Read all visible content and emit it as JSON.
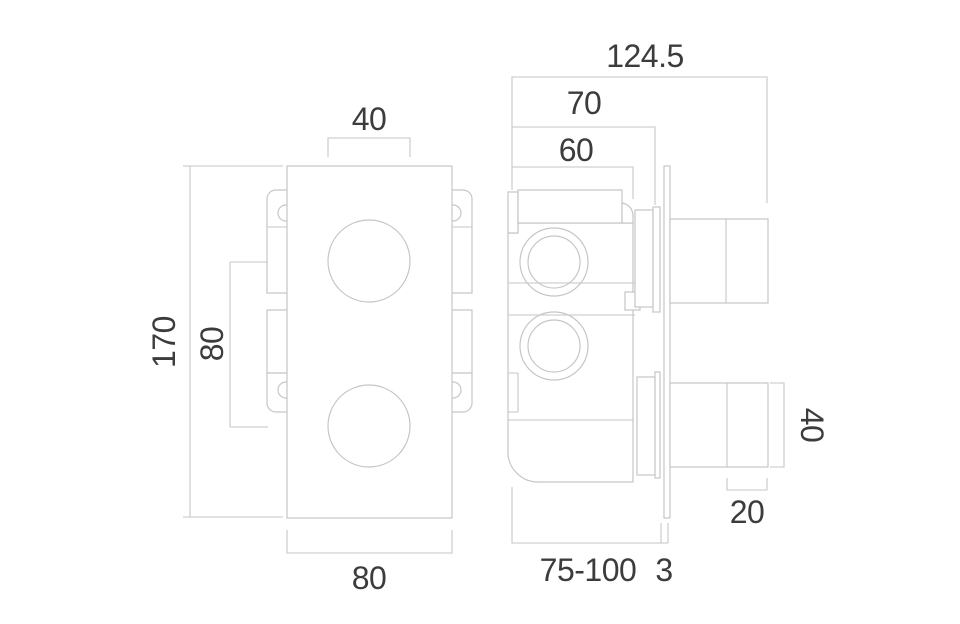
{
  "page": {
    "background": "#ffffff"
  },
  "drawing": {
    "title": "shower-valve-dimension-drawing",
    "line_color": "#c6c6c6",
    "text_color": "#3c3c3c",
    "views": {
      "front_view": {
        "name": "front view",
        "dimensions": {
          "hole_diameter": "40",
          "height": "170",
          "hole_spacing": "80",
          "width": "80"
        }
      },
      "side_view": {
        "name": "side view",
        "dimensions": {
          "overall_depth": "124.5",
          "depth_to_cartridge_face": "70",
          "body_depth": "60",
          "handle_height": "40",
          "handle_cap_depth": "20",
          "installation_depth_range": "75-100",
          "plate_thickness": "3"
        }
      }
    }
  }
}
